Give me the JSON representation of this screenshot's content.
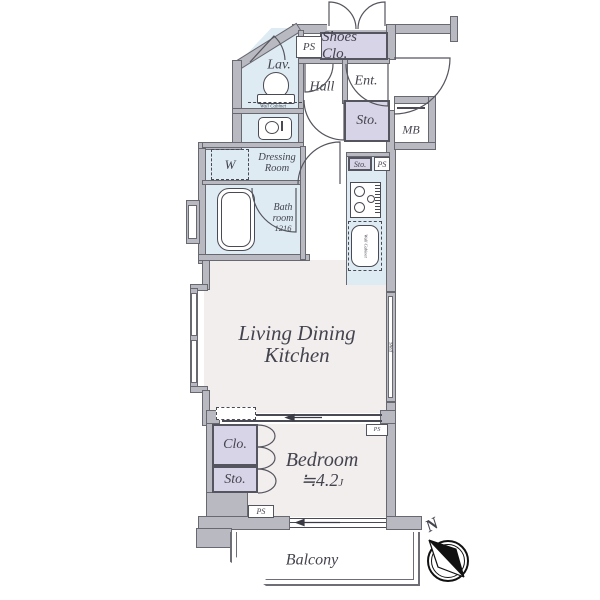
{
  "colors": {
    "wall": "#b9b9c1",
    "wall_line": "#686871",
    "water_blue": "#deebf3",
    "closet_purple": "#d7d4e7",
    "floor_pink": "#f3eeee",
    "text": "#44444e"
  },
  "rooms": {
    "lavatory": "Lav.",
    "hall": "Hall",
    "entrance": "Ent.",
    "shoes_closet": "Shoes Clo.",
    "entrance_storage": "Sto.",
    "meter_box": "MB",
    "dressing_room_line1": "Dressing",
    "dressing_room_line2": "Room",
    "bath_line1": "Bath",
    "bath_line2": "room",
    "bath_size": "1216",
    "washer": "W",
    "kitchen_storage": "Sto.",
    "living_line1": "Living Dining",
    "living_line2": "Kitchen",
    "shelf": "Shelf",
    "bedroom": "Bedroom",
    "bedroom_size": "≒4.2",
    "bedroom_size_unit": "J",
    "bedroom_closet": "Clo.",
    "bedroom_storage": "Sto.",
    "balcony": "Balcony"
  },
  "labels": {
    "pipe_space_top": "PS",
    "pipe_space_kitchen": "PS",
    "pipe_space_bedroom": "PS",
    "pipe_space_bedroom_corner": "PS",
    "wall_cabinet_lav": "Wall Cabinet",
    "wall_cabinet_kitchen": "Wall Cabinet",
    "compass_north": "N"
  }
}
